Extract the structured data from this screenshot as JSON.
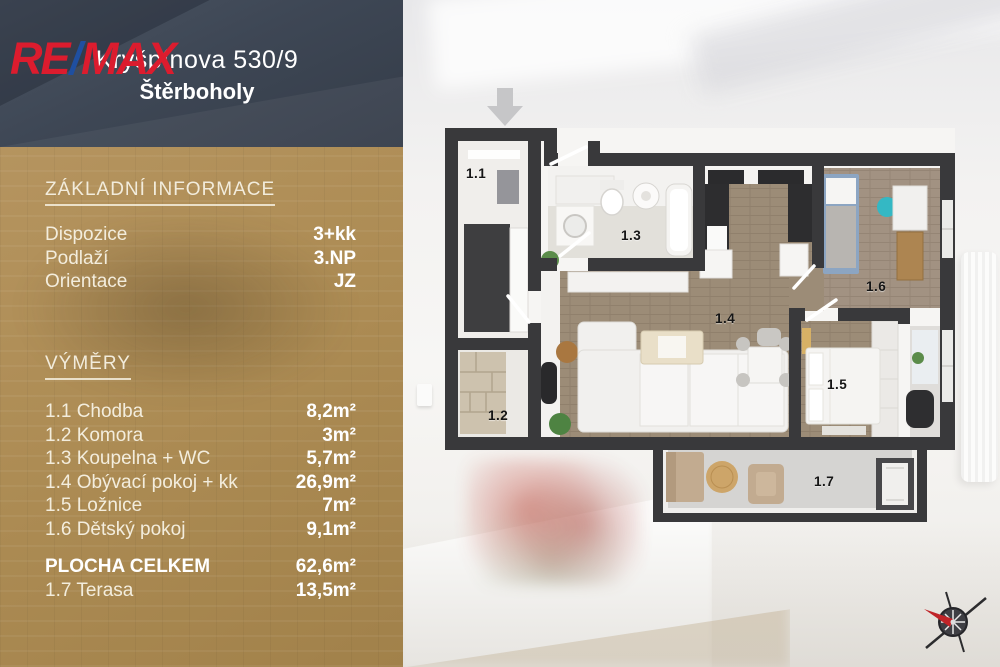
{
  "header": {
    "logo_re": "RE",
    "logo_slash": "/",
    "logo_max": "MAX",
    "address_line1": "Kryšpínova 530/9",
    "address_line2": "Štěrboholy"
  },
  "info_panel": {
    "basic_title": "ZÁKLADNÍ INFORMACE",
    "basic_rows": [
      {
        "label": "Dispozice",
        "value": "3+kk"
      },
      {
        "label": "Podlaží",
        "value": "3.NP"
      },
      {
        "label": "Orientace",
        "value": "JZ"
      }
    ],
    "areas_title": "VÝMĚRY",
    "area_rows": [
      {
        "label": "1.1 Chodba",
        "value": "8,2m²"
      },
      {
        "label": "1.2 Komora",
        "value": "3m²"
      },
      {
        "label": "1.3 Koupelna + WC",
        "value": "5,7m²"
      },
      {
        "label": "1.4 Obývací pokoj + kk",
        "value": "26,9m²"
      },
      {
        "label": "1.5 Ložnice",
        "value": "7m²"
      },
      {
        "label": "1.6 Dětský pokoj",
        "value": "9,1m²"
      }
    ],
    "total_row": {
      "label": "PLOCHA CELKEM",
      "value": "62,6m²"
    },
    "terrace_row": {
      "label": "1.7 Terasa",
      "value": "13,5m²"
    }
  },
  "floor_plan": {
    "room_labels": [
      "1.1",
      "1.2",
      "1.3",
      "1.4",
      "1.5",
      "1.6",
      "1.7"
    ],
    "icons": [
      "entrance-arrow-icon",
      "compass-rose-icon"
    ]
  },
  "colors": {
    "brand_red": "#dc1c2e",
    "brand_blue": "#1f4fa0",
    "header_bg": "#3e4755",
    "panel_gold": "#ad8c54",
    "wall_dark": "#39393b",
    "floor_wood": "#9c8c77",
    "accent_teal": "#34b8c4"
  }
}
